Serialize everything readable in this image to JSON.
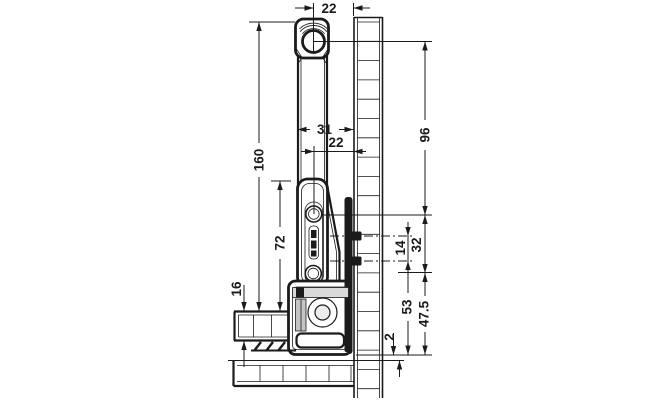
{
  "drawing": {
    "colors": {
      "line": "#1b1b1b",
      "background": "#ffffff",
      "fill_light": "#d9d9d9",
      "fill_mid": "#c4c4c4"
    },
    "dimensions": {
      "d22_top": {
        "value": "22"
      },
      "d31": {
        "value": "31"
      },
      "d22_mid": {
        "value": "22"
      },
      "d96": {
        "value": "96"
      },
      "d160": {
        "value": "160"
      },
      "d72": {
        "value": "72"
      },
      "d16": {
        "value": "16"
      },
      "d14": {
        "value": "14"
      },
      "d32": {
        "value": "32"
      },
      "d53": {
        "value": "53"
      },
      "d47_5": {
        "value": "47.5"
      },
      "d2": {
        "value": "2"
      }
    }
  }
}
